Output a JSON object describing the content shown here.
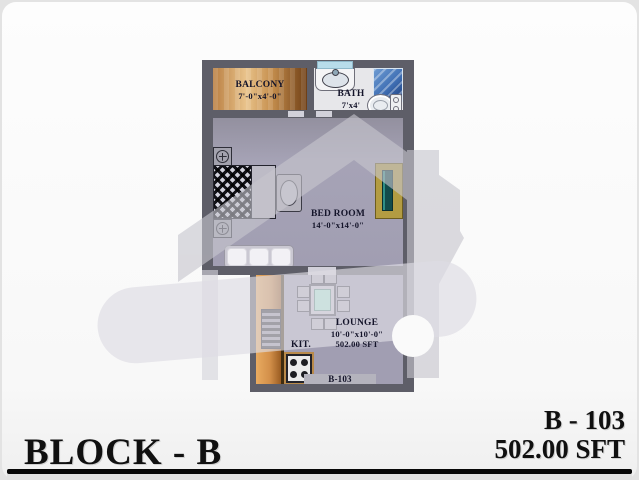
{
  "footer": {
    "block_title": "BLOCK - B",
    "unit_number": "B - 103",
    "unit_area": "502.00 SFT"
  },
  "plan": {
    "unit_label": "B-103",
    "balcony": {
      "name": "BALCONY",
      "dims": "7'-0\"x4'-0\""
    },
    "bath": {
      "name": "BATH",
      "dims": "7'x4'"
    },
    "bedroom": {
      "name": "BED ROOM",
      "dims": "14'-0\"x14'-0\""
    },
    "lounge": {
      "name": "LOUNGE",
      "dims": "10'-0\"x10'-0\"",
      "area": "502.00 SFT"
    },
    "kitchen": {
      "name": "KIT."
    }
  },
  "colors": {
    "floor": "#a19eb2",
    "wall": "#5e5e68",
    "balcony_wood": "#c68f4e",
    "kitchen_counter": "#d3904a",
    "shower_blue": "#3f6fb4",
    "table_top": "#aee9d6",
    "tv_teal": "#124b4b",
    "watermark_gray": "#c7c6ce"
  }
}
